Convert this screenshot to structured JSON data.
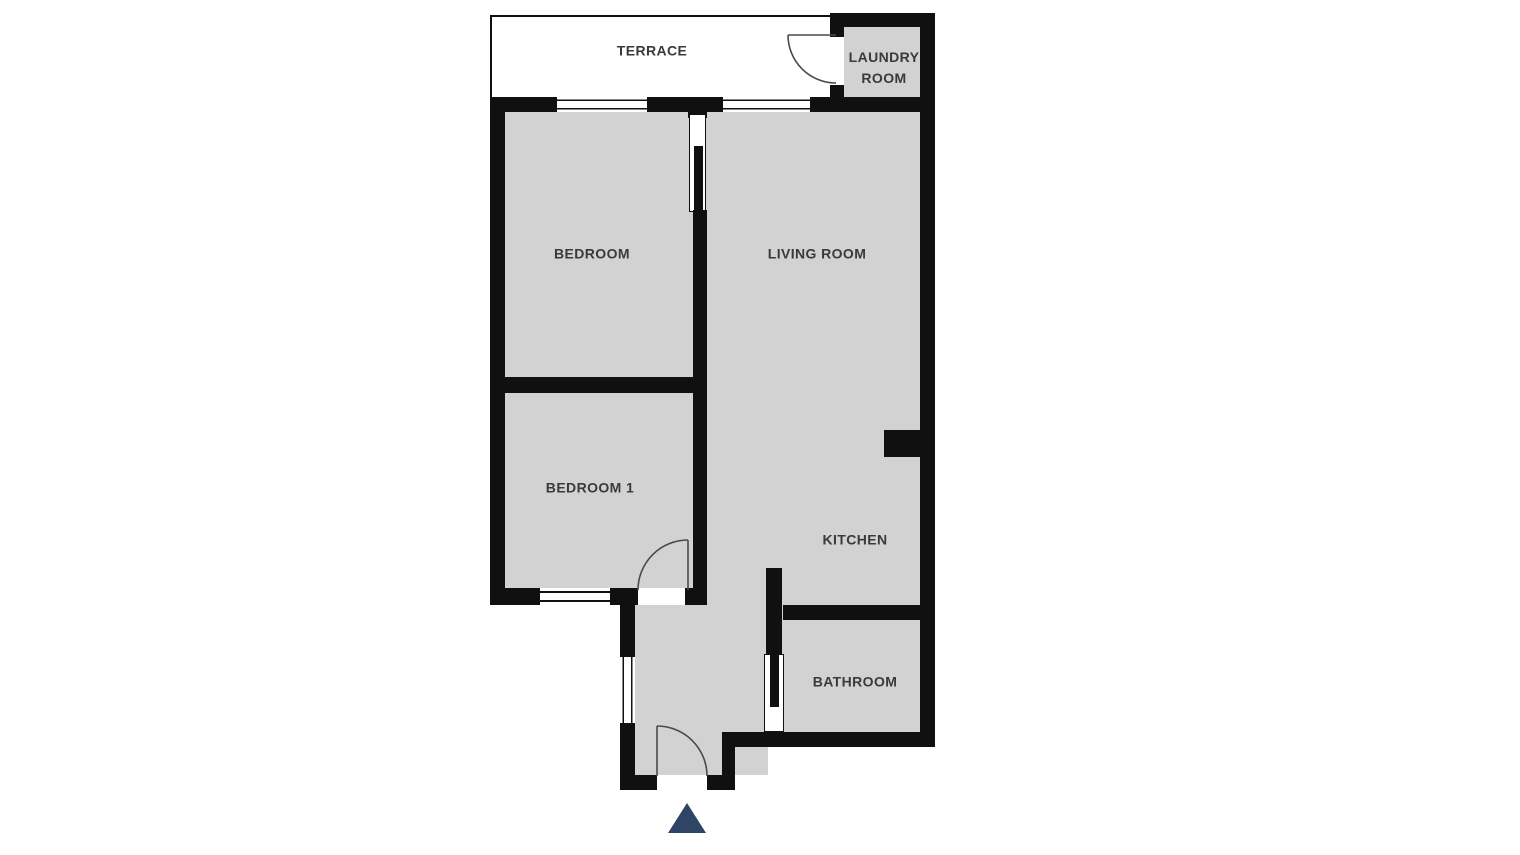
{
  "floorplan": {
    "rooms": {
      "terrace": {
        "label": "TERRACE"
      },
      "laundry": {
        "label_line1": "LAUNDRY",
        "label_line2": "ROOM"
      },
      "bedroom": {
        "label": "BEDROOM"
      },
      "living_room": {
        "label": "LIVING ROOM"
      },
      "bedroom1": {
        "label": "BEDROOM 1"
      },
      "kitchen": {
        "label": "KITCHEN"
      },
      "bathroom": {
        "label": "BATHROOM"
      }
    },
    "markers": {
      "entrance_arrow": "up-triangle"
    },
    "colors": {
      "room_fill": "#d2d2d2",
      "terrace_fill": "#ffffff",
      "wall": "#101010",
      "door_line": "#4a4a4a",
      "label_text": "#3a3a3a",
      "entrance_arrow": "#2e4566"
    }
  }
}
